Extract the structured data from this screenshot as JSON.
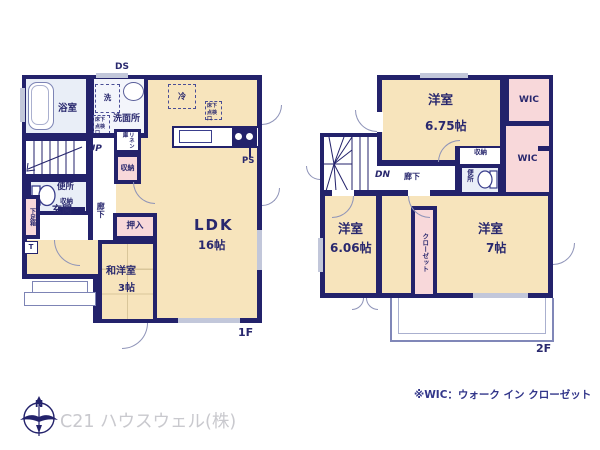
{
  "colors": {
    "wall": "#23226b",
    "room_fill": "#f7e4bc",
    "closet_fill": "#f8d8da",
    "wet_fill": "#e9eef7",
    "window_mark": "#c2c7da",
    "note_text": "#32368a",
    "company_text": "#c9c9ce"
  },
  "floor1": {
    "floor_label": "1F",
    "ds": "DS",
    "bathroom": "浴室",
    "washer": "洗",
    "washroom": "洗面所",
    "washroom_hatch": "床下点検口",
    "linen": "リネン庫",
    "storage_washroom": "収納",
    "up": "UP",
    "toilet": "便所",
    "storage_toilet": "収納",
    "shoe_box": "下足箱",
    "shoe_box_t": "T",
    "entrance": "玄関",
    "hallway": "廊下",
    "fridge": "冷",
    "kitchen_hatch": "床下点検口",
    "ps": "PS",
    "ldk_name": "LDK",
    "ldk_size": "16帖",
    "oshiire": "押入",
    "tatami_name": "和洋室",
    "tatami_size": "3帖"
  },
  "floor2": {
    "floor_label": "2F",
    "dn": "DN",
    "hallway": "廊下",
    "room675_name": "洋室",
    "room675_size": "6.75帖",
    "wic_upper": "WIC",
    "wic_lower": "WIC",
    "storage": "収納",
    "toilet": "便所",
    "room606_name": "洋室",
    "room606_size": "6.06帖",
    "closet": "クローゼット",
    "room7_name": "洋室",
    "room7_size": "7帖"
  },
  "footer": {
    "wic_note": "※WIC：ウォーク イン クローゼット",
    "company": "C21 ハウスウェル(株)",
    "compass_north": "N"
  }
}
